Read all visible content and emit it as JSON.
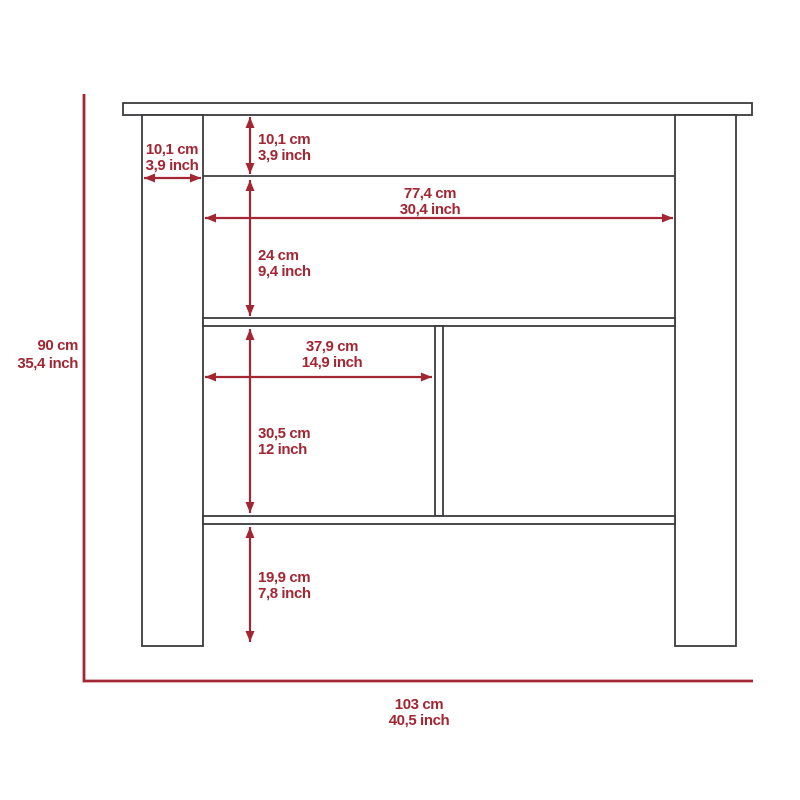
{
  "colors": {
    "accent": "#A22733",
    "outline": "#3B3B3D",
    "background": "#FFFFFF"
  },
  "diagram": {
    "dimensions": {
      "leg_width": {
        "cm": "10,1 cm",
        "inch": "3,9 inch"
      },
      "top_frame_height": {
        "cm": "10,1 cm",
        "inch": "3,9 inch"
      },
      "interior_width": {
        "cm": "77,4 cm",
        "inch": "30,4 inch"
      },
      "upper_shelf_height": {
        "cm": "24 cm",
        "inch": "9,4 inch"
      },
      "cubby_width": {
        "cm": "37,9 cm",
        "inch": "14,9 inch"
      },
      "cubby_height": {
        "cm": "30,5 cm",
        "inch": "12 inch"
      },
      "bottom_clearance": {
        "cm": "19,9 cm",
        "inch": "7,8 inch"
      },
      "overall_height": {
        "cm": "90 cm",
        "inch": "35,4 inch"
      },
      "overall_width": {
        "cm": "103 cm",
        "inch": "40,5 inch"
      }
    }
  }
}
